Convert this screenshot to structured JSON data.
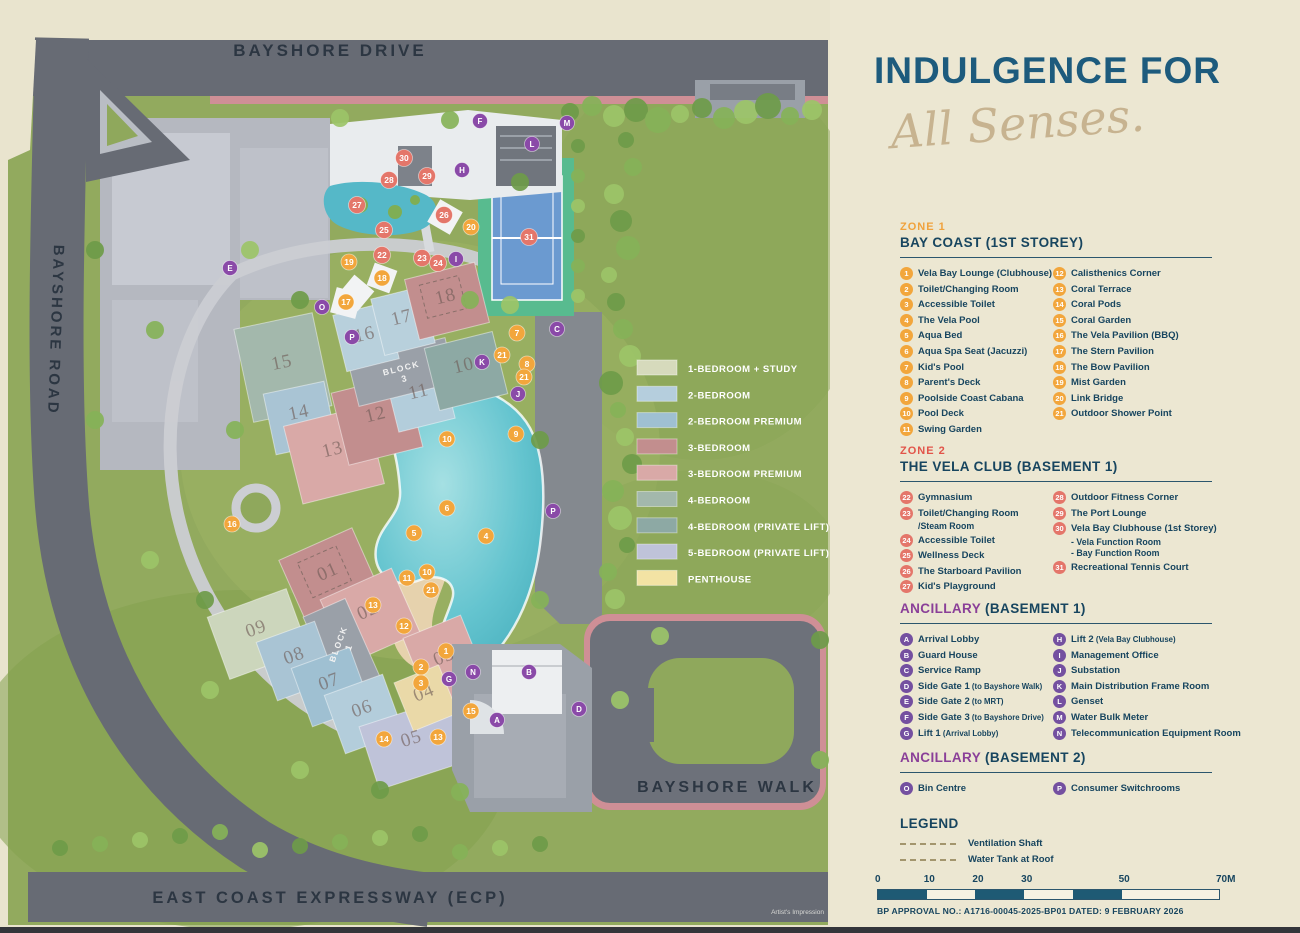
{
  "panel": {
    "title": "INDULGENCE FOR",
    "subtitle": "All Senses.",
    "colors": {
      "teal": "#1d5b7d",
      "navy": "#17455f",
      "gold": "#f0a23c",
      "coral": "#e25449",
      "purple": "#8a3f98"
    },
    "sections": [
      {
        "tag": "ZONE 1",
        "tagColor": "#f0a23c",
        "title": "BAY COAST (1ST STOREY)",
        "badge": "#f2a63c",
        "top": 221,
        "col1": [
          {
            "k": "1",
            "t": "Vela Bay Lounge (Clubhouse)"
          },
          {
            "k": "2",
            "t": "Toilet/Changing Room"
          },
          {
            "k": "3",
            "t": "Accessible Toilet"
          },
          {
            "k": "4",
            "t": "The Vela Pool"
          },
          {
            "k": "5",
            "t": "Aqua Bed"
          },
          {
            "k": "6",
            "t": "Aqua Spa Seat (Jacuzzi)"
          },
          {
            "k": "7",
            "t": "Kid's Pool"
          },
          {
            "k": "8",
            "t": "Parent's Deck"
          },
          {
            "k": "9",
            "t": "Poolside Coast Cabana"
          },
          {
            "k": "10",
            "t": "Pool Deck"
          },
          {
            "k": "11",
            "t": "Swing Garden"
          }
        ],
        "col2": [
          {
            "k": "12",
            "t": "Calisthenics Corner"
          },
          {
            "k": "13",
            "t": "Coral Terrace"
          },
          {
            "k": "14",
            "t": "Coral Pods"
          },
          {
            "k": "15",
            "t": "Coral Garden"
          },
          {
            "k": "16",
            "t": "The Vela Pavilion (BBQ)"
          },
          {
            "k": "17",
            "t": "The Stern Pavilion"
          },
          {
            "k": "18",
            "t": "The Bow Pavilion"
          },
          {
            "k": "19",
            "t": "Mist Garden"
          },
          {
            "k": "20",
            "t": "Link Bridge"
          },
          {
            "k": "21",
            "t": "Outdoor Shower Point"
          }
        ]
      },
      {
        "tag": "ZONE 2",
        "tagColor": "#e25449",
        "title": "THE VELA CLUB (BASEMENT 1)",
        "badge": "#e4766a",
        "top": 445,
        "col1": [
          {
            "k": "22",
            "t": "Gymnasium"
          },
          {
            "k": "23",
            "t": "Toilet/Changing Room",
            "sub": [
              "/Steam Room"
            ]
          },
          {
            "k": "24",
            "t": "Accessible Toilet"
          },
          {
            "k": "25",
            "t": "Wellness Deck"
          },
          {
            "k": "26",
            "t": "The Starboard Pavilion"
          },
          {
            "k": "27",
            "t": "Kid's Playground"
          }
        ],
        "col2": [
          {
            "k": "28",
            "t": "Outdoor Fitness Corner"
          },
          {
            "k": "29",
            "t": "The Port Lounge"
          },
          {
            "k": "30",
            "t": "Vela Bay Clubhouse (1st Storey)",
            "sub": [
              "- Vela Function Room",
              "- Bay Function Room"
            ]
          },
          {
            "k": "31",
            "t": "Recreational Tennis Court"
          }
        ]
      },
      {
        "accent": "ANCILLARY",
        "accentColor": "#8a3f98",
        "title": " (BASEMENT 1)",
        "badge": "#7450a0",
        "top": 599,
        "col1": [
          {
            "k": "A",
            "t": "Arrival Lobby"
          },
          {
            "k": "B",
            "t": "Guard House"
          },
          {
            "k": "C",
            "t": "Service Ramp"
          },
          {
            "k": "D",
            "t": "Side Gate 1",
            "n": "(to Bayshore Walk)"
          },
          {
            "k": "E",
            "t": "Side Gate 2",
            "n": "(to MRT)"
          },
          {
            "k": "F",
            "t": "Side Gate 3",
            "n": "(to Bayshore Drive)"
          },
          {
            "k": "G",
            "t": "Lift 1",
            "n": "(Arrival Lobby)"
          }
        ],
        "col2": [
          {
            "k": "H",
            "t": "Lift 2",
            "n": "(Vela Bay Clubhouse)"
          },
          {
            "k": "I",
            "t": "Management Office"
          },
          {
            "k": "J",
            "t": "Substation"
          },
          {
            "k": "K",
            "t": "Main Distribution Frame Room"
          },
          {
            "k": "L",
            "t": "Genset"
          },
          {
            "k": "M",
            "t": "Water Bulk Meter"
          },
          {
            "k": "N",
            "t": "Telecommunication Equipment Room"
          }
        ]
      },
      {
        "accent": "ANCILLARY",
        "accentColor": "#8a3f98",
        "title": " (BASEMENT 2)",
        "badge": "#7450a0",
        "top": 748,
        "col1": [
          {
            "k": "O",
            "t": "Bin Centre"
          }
        ],
        "col2": [
          {
            "k": "P",
            "t": "Consumer Switchrooms"
          }
        ]
      }
    ],
    "legend": {
      "title": "LEGEND",
      "top": 814,
      "items": [
        "Ventilation Shaft",
        "Water Tank at Roof"
      ]
    },
    "scale": {
      "ticks": [
        {
          "v": 0,
          "label": "0"
        },
        {
          "v": 10,
          "label": "10"
        },
        {
          "v": 20,
          "label": "20"
        },
        {
          "v": 30,
          "label": "30"
        },
        {
          "v": 50,
          "label": "50"
        },
        {
          "v": 70,
          "label": "70M"
        }
      ],
      "max": 70,
      "bar_px": 341,
      "segments": [
        [
          0,
          10,
          "#1e5a74"
        ],
        [
          10,
          20,
          "#f6f2e2"
        ],
        [
          20,
          30,
          "#1e5a74"
        ],
        [
          30,
          40,
          "#f6f2e2"
        ],
        [
          40,
          50,
          "#1e5a74"
        ],
        [
          50,
          70,
          "#f6f2e2"
        ]
      ],
      "north_label": "N"
    },
    "approval": "BP APPROVAL NO.: A1716-00045-2025-BP01 DATED: 9 FEBRUARY 2026"
  },
  "map": {
    "credit": "Artist's Impression",
    "roads": [
      {
        "name": "BAYSHORE DRIVE",
        "x": 330,
        "y": 56,
        "rot": 0,
        "size": 17
      },
      {
        "name": "BAYSHORE ROAD",
        "x": 51,
        "y": 330,
        "rot": 92,
        "size": 15
      },
      {
        "name": "BAYSHORE WALK",
        "x": 727,
        "y": 792,
        "rot": 0,
        "size": 16
      },
      {
        "name": "EAST COAST EXPRESSWAY (ECP)",
        "x": 330,
        "y": 903,
        "rot": 0,
        "size": 16.5
      }
    ],
    "unit_legend": {
      "x": 637,
      "y": 360,
      "row_h": 26.3,
      "items": [
        {
          "label": "1-BEDROOM + STUDY",
          "color": "#d6dabc"
        },
        {
          "label": "2-BEDROOM",
          "color": "#b5cedd"
        },
        {
          "label": "2-BEDROOM PREMIUM",
          "color": "#9fc0d2"
        },
        {
          "label": "3-BEDROOM",
          "color": "#c28e8e"
        },
        {
          "label": "3-BEDROOM PREMIUM",
          "color": "#d9a9a7"
        },
        {
          "label": "4-BEDROOM",
          "color": "#a3b8ac"
        },
        {
          "label": "4-BEDROOM (PRIVATE LIFT)",
          "color": "#8da9a4"
        },
        {
          "label": "5-BEDROOM (PRIVATE LIFT)",
          "color": "#bfc3d9"
        },
        {
          "label": "PENTHOUSE",
          "color": "#f3e3a4"
        }
      ]
    },
    "blocks": [
      {
        "label": "BLOCK",
        "num": "3",
        "x": 402,
        "y": 371,
        "rot": -14
      },
      {
        "label": "BLOCK",
        "num": "1",
        "x": 341,
        "y": 645,
        "rot": -70
      }
    ],
    "units": [
      {
        "n": "15",
        "x": 283,
        "y": 368,
        "rot": -12
      },
      {
        "n": "14",
        "x": 300,
        "y": 418,
        "rot": -12
      },
      {
        "n": "13",
        "x": 334,
        "y": 455,
        "rot": -14
      },
      {
        "n": "12",
        "x": 377,
        "y": 420,
        "rot": -14
      },
      {
        "n": "11",
        "x": 420,
        "y": 397,
        "rot": -14
      },
      {
        "n": "16",
        "x": 366,
        "y": 340,
        "rot": -14
      },
      {
        "n": "17",
        "x": 403,
        "y": 323,
        "rot": -14
      },
      {
        "n": "18",
        "x": 447,
        "y": 302,
        "rot": -14
      },
      {
        "n": "10",
        "x": 465,
        "y": 371,
        "rot": -14
      },
      {
        "n": "01",
        "x": 330,
        "y": 577,
        "rot": -24
      },
      {
        "n": "02",
        "x": 370,
        "y": 616,
        "rot": -24
      },
      {
        "n": "09",
        "x": 258,
        "y": 634,
        "rot": -20
      },
      {
        "n": "08",
        "x": 296,
        "y": 661,
        "rot": -20
      },
      {
        "n": "07",
        "x": 331,
        "y": 687,
        "rot": -20
      },
      {
        "n": "06",
        "x": 364,
        "y": 714,
        "rot": -20
      },
      {
        "n": "05",
        "x": 413,
        "y": 744,
        "rot": -18
      },
      {
        "n": "03",
        "x": 446,
        "y": 662,
        "rot": -22
      },
      {
        "n": "04",
        "x": 426,
        "y": 698,
        "rot": -22
      }
    ],
    "markers": {
      "zone1": {
        "color": "#f2a63c",
        "items": [
          {
            "k": "1",
            "x": 446,
            "y": 651
          },
          {
            "k": "2",
            "x": 421,
            "y": 667
          },
          {
            "k": "3",
            "x": 421,
            "y": 683
          },
          {
            "k": "4",
            "x": 486,
            "y": 536
          },
          {
            "k": "5",
            "x": 414,
            "y": 533
          },
          {
            "k": "6",
            "x": 447,
            "y": 508
          },
          {
            "k": "7",
            "x": 517,
            "y": 333
          },
          {
            "k": "8",
            "x": 527,
            "y": 364
          },
          {
            "k": "9",
            "x": 516,
            "y": 434
          },
          {
            "k": "10",
            "x": 447,
            "y": 439
          },
          {
            "k": "10",
            "x": 427,
            "y": 572
          },
          {
            "k": "11",
            "x": 407,
            "y": 578
          },
          {
            "k": "12",
            "x": 404,
            "y": 626
          },
          {
            "k": "13",
            "x": 373,
            "y": 605
          },
          {
            "k": "13",
            "x": 438,
            "y": 737
          },
          {
            "k": "14",
            "x": 384,
            "y": 739
          },
          {
            "k": "15",
            "x": 471,
            "y": 711
          },
          {
            "k": "16",
            "x": 232,
            "y": 524
          },
          {
            "k": "17",
            "x": 346,
            "y": 302
          },
          {
            "k": "18",
            "x": 382,
            "y": 278
          },
          {
            "k": "19",
            "x": 349,
            "y": 262
          },
          {
            "k": "20",
            "x": 471,
            "y": 227
          },
          {
            "k": "21",
            "x": 502,
            "y": 355
          },
          {
            "k": "21",
            "x": 524,
            "y": 377
          },
          {
            "k": "21",
            "x": 431,
            "y": 590
          }
        ]
      },
      "zone2": {
        "color": "#e4766a",
        "items": [
          {
            "k": "22",
            "x": 382,
            "y": 255
          },
          {
            "k": "23",
            "x": 422,
            "y": 258
          },
          {
            "k": "24",
            "x": 438,
            "y": 263
          },
          {
            "k": "25",
            "x": 384,
            "y": 230
          },
          {
            "k": "26",
            "x": 444,
            "y": 215
          },
          {
            "k": "27",
            "x": 357,
            "y": 205
          },
          {
            "k": "28",
            "x": 389,
            "y": 180
          },
          {
            "k": "29",
            "x": 427,
            "y": 176
          },
          {
            "k": "30",
            "x": 404,
            "y": 158
          },
          {
            "k": "31",
            "x": 529,
            "y": 237
          }
        ]
      },
      "ancillary": {
        "color": "#8a4aa8",
        "items": [
          {
            "k": "A",
            "x": 497,
            "y": 720
          },
          {
            "k": "B",
            "x": 529,
            "y": 672
          },
          {
            "k": "C",
            "x": 557,
            "y": 329
          },
          {
            "k": "D",
            "x": 579,
            "y": 709
          },
          {
            "k": "E",
            "x": 230,
            "y": 268
          },
          {
            "k": "F",
            "x": 480,
            "y": 121
          },
          {
            "k": "G",
            "x": 449,
            "y": 679
          },
          {
            "k": "H",
            "x": 462,
            "y": 170
          },
          {
            "k": "I",
            "x": 456,
            "y": 259
          },
          {
            "k": "J",
            "x": 518,
            "y": 394
          },
          {
            "k": "K",
            "x": 482,
            "y": 362
          },
          {
            "k": "L",
            "x": 532,
            "y": 144
          },
          {
            "k": "M",
            "x": 567,
            "y": 123
          },
          {
            "k": "N",
            "x": 473,
            "y": 672
          },
          {
            "k": "O",
            "x": 322,
            "y": 307
          },
          {
            "k": "P",
            "x": 352,
            "y": 337
          },
          {
            "k": "P",
            "x": 553,
            "y": 511
          }
        ]
      }
    }
  }
}
